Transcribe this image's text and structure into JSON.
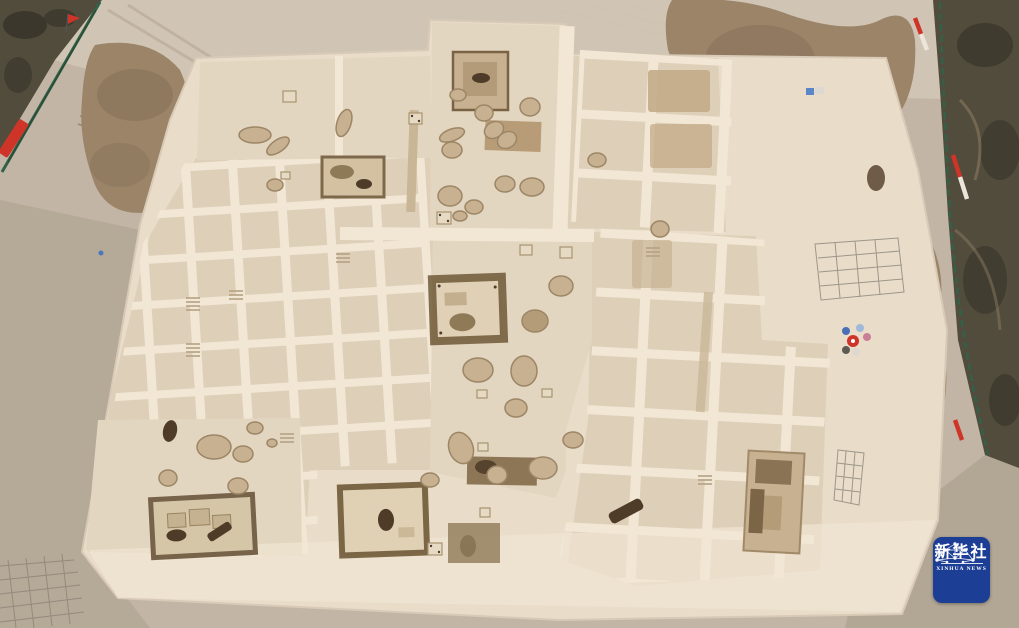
{
  "meta": {
    "description": "Aerial photograph of an archaeological excavation site: a large grid of square excavation units separated by earthen balks, with pits, house foundations, spoil heaps, boundary fences and survey markers",
    "photo_type": "news agency aerial photo"
  },
  "watermark": {
    "name_cn": "新华社",
    "name_en": "XINHUA NEWS"
  },
  "colors": {
    "ground": "#c2b5a5",
    "ground_light": "#d2c6b6",
    "dirt_texture": "#ac9e8d",
    "site": "#e9ddc9",
    "cell": "#decfb9",
    "cell_open": "#e3d6c1",
    "balk": "#f1e7d4",
    "spoil": "#9b8468",
    "spoil_dark": "#877159",
    "vegetation": "#524c3c",
    "vegetation_dark": "#3b372c",
    "pit": "#c7b191",
    "pit_edge": "#9c8666",
    "brown_cell": "#c3ab88",
    "feature_dark": "#4f3c28",
    "house_ring": "#6f5937",
    "fence_green": "#336049",
    "marker_red": "#cf3429",
    "dirt_bottom_right": "#b2a695",
    "logo_blue": "#1c3e95"
  }
}
